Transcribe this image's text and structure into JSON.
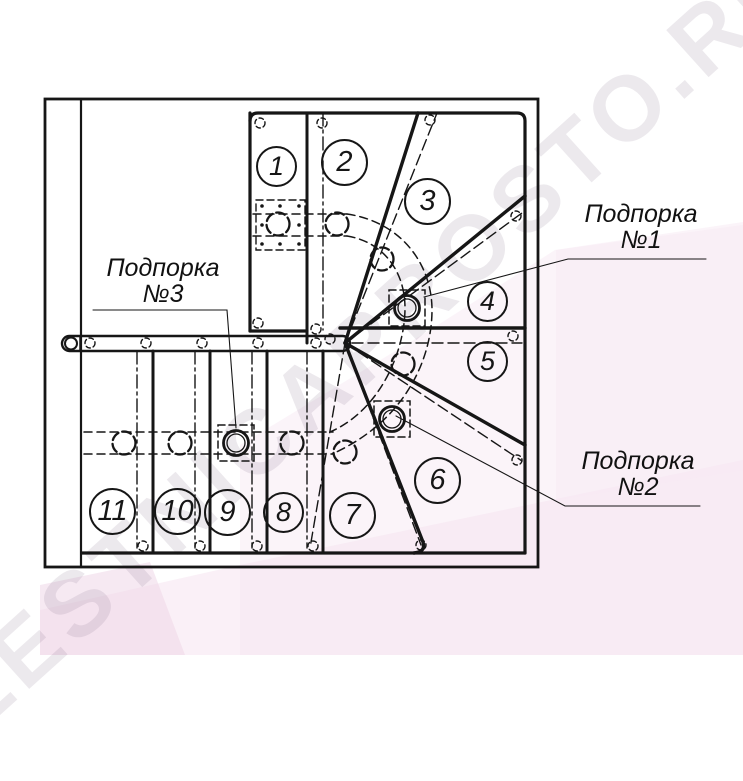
{
  "drawing": {
    "title": "Winder staircase plan view",
    "type": "technical-diagram"
  },
  "steps": [
    "1",
    "2",
    "3",
    "4",
    "5",
    "6",
    "7",
    "8",
    "9",
    "10",
    "11"
  ],
  "supports": [
    {
      "line1": "Подпорка",
      "line2": "№1"
    },
    {
      "line1": "Подпорка",
      "line2": "№2"
    },
    {
      "line1": "Подпорка",
      "line2": "№3"
    }
  ],
  "watermark": {
    "text": "LESTNICAPROSTO.RU"
  },
  "colors": {
    "line": "#161616",
    "pink_ribbon": "#f4e0ee",
    "pink_accent": "#eed7e8",
    "watermark_gray": "#8a7a8f"
  }
}
